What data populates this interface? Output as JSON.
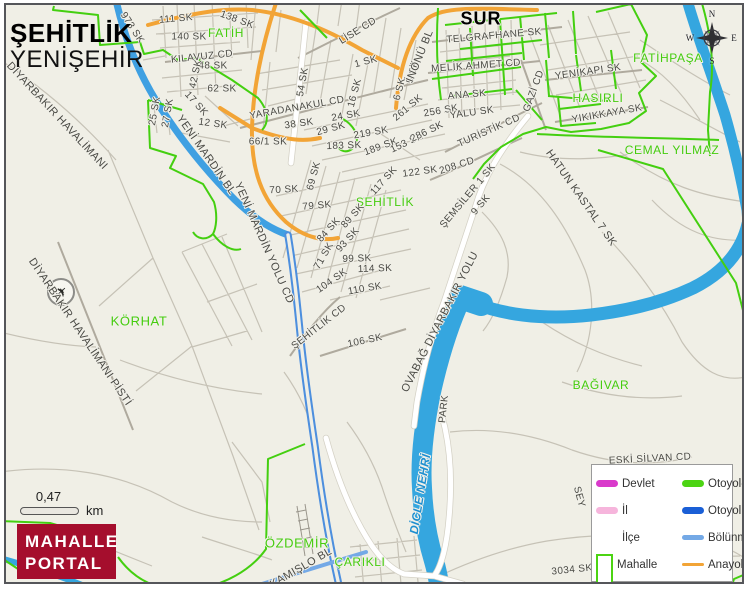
{
  "map_title": {
    "primary": "ŞEHİTLİK",
    "secondary": "YENİŞEHİR"
  },
  "scale_bar": {
    "distance": "0,47",
    "unit": "km"
  },
  "logo": {
    "line1": "MAHALLE",
    "line2": "PORTAL",
    "bg_color": "#A50E2D"
  },
  "compass": {
    "north": "N",
    "east": "E",
    "south": "S",
    "west": "W"
  },
  "legend": {
    "items": [
      {
        "label": "Devlet",
        "swatch": "line-thick",
        "color": "#D93ACB"
      },
      {
        "label": "İl",
        "swatch": "line-thick",
        "color": "#F6B5DC"
      },
      {
        "label": "İlçe",
        "swatch": "line-none",
        "color": "#FFFFFF"
      },
      {
        "label": "Mahalle",
        "swatch": "rect-outline",
        "color": "#4CD413"
      },
      {
        "label": "Otoyol-YİD",
        "swatch": "line-thick",
        "color": "#4CD413"
      },
      {
        "label": "Otoyol",
        "swatch": "line-thick",
        "color": "#1A5FD6"
      },
      {
        "label": "Bölünmüş Y",
        "swatch": "line-med",
        "color": "#74A9E6"
      },
      {
        "label": "Anayol",
        "swatch": "line-thin",
        "color": "#F2A436"
      }
    ]
  },
  "colors": {
    "background": "#F0EFE6",
    "river": "#35A6DF",
    "motorway_road": "#3FA0E2",
    "divided_road": "#4D8FDE",
    "main_road_orange": "#F2A436",
    "minor_road": "#C6C2B6",
    "major_road": "#AFAA9E",
    "boundary_green": "#44CF10",
    "white_road": "#FFFFFF",
    "label_green": "#45CC0E",
    "water_label": "#1E8FD0",
    "logo_red": "#A50E2D"
  },
  "labels": [
    {
      "t": "973 SK",
      "x": 132,
      "y": 28,
      "r": 57
    },
    {
      "t": "111 SK",
      "x": 176,
      "y": 19,
      "r": -5
    },
    {
      "t": "138 SK",
      "x": 237,
      "y": 20,
      "r": 20
    },
    {
      "t": "140 SK",
      "x": 189,
      "y": 37,
      "r": 0
    },
    {
      "t": "FATİH",
      "x": 226,
      "y": 33,
      "r": 0,
      "c": "mah"
    },
    {
      "t": "KILAVUZ CD",
      "x": 202,
      "y": 57,
      "r": -6
    },
    {
      "t": "48 SK",
      "x": 213,
      "y": 66,
      "r": 0
    },
    {
      "t": "42 SK",
      "x": 196,
      "y": 74,
      "r": -78
    },
    {
      "t": "62 SK",
      "x": 222,
      "y": 89,
      "r": 0
    },
    {
      "t": "17 SK",
      "x": 196,
      "y": 104,
      "r": 48
    },
    {
      "t": "12 SK",
      "x": 213,
      "y": 124,
      "r": 8
    },
    {
      "t": "25 SK",
      "x": 155,
      "y": 111,
      "r": -80
    },
    {
      "t": "27 SK",
      "x": 168,
      "y": 113,
      "r": -80
    },
    {
      "t": "DİYARBAKIR HAVALİMANI",
      "x": 57,
      "y": 116,
      "r": 47,
      "s": 11
    },
    {
      "t": "DİYARBAKIR HAVALİMANI PİSTİ",
      "x": 80,
      "y": 332,
      "r": 56,
      "s": 11
    },
    {
      "t": "KÖRHAT",
      "x": 139,
      "y": 321,
      "r": 0,
      "c": "mah",
      "s": 13
    },
    {
      "t": "YENİ MARDİN BL",
      "x": 206,
      "y": 155,
      "r": 55,
      "s": 11
    },
    {
      "t": "YENİ MARDİN YOLU CD",
      "x": 264,
      "y": 243,
      "r": 66,
      "s": 11
    },
    {
      "t": "66/1 SK",
      "x": 268,
      "y": 142,
      "r": 0
    },
    {
      "t": "YARADANAKUL CD",
      "x": 297,
      "y": 108,
      "r": -10
    },
    {
      "t": "38 SK",
      "x": 299,
      "y": 124,
      "r": -8
    },
    {
      "t": "29 SK",
      "x": 331,
      "y": 129,
      "r": -15
    },
    {
      "t": "219 SK",
      "x": 371,
      "y": 133,
      "r": -10
    },
    {
      "t": "183 SK",
      "x": 344,
      "y": 146,
      "r": -2
    },
    {
      "t": "189 SK",
      "x": 381,
      "y": 147,
      "r": -20
    },
    {
      "t": "153 SK",
      "x": 407,
      "y": 143,
      "r": -25
    },
    {
      "t": "24 SK",
      "x": 346,
      "y": 116,
      "r": -10
    },
    {
      "t": "16 SK",
      "x": 355,
      "y": 93,
      "r": -75
    },
    {
      "t": "54 SK",
      "x": 303,
      "y": 82,
      "r": -80
    },
    {
      "t": "1 SK",
      "x": 366,
      "y": 62,
      "r": -15
    },
    {
      "t": "LİSE CD",
      "x": 358,
      "y": 31,
      "r": -32
    },
    {
      "t": "5 SK",
      "x": 413,
      "y": 72,
      "r": -75
    },
    {
      "t": "6 SK",
      "x": 400,
      "y": 89,
      "r": -75
    },
    {
      "t": "261 SK",
      "x": 408,
      "y": 108,
      "r": -40
    },
    {
      "t": "256 SK",
      "x": 441,
      "y": 111,
      "r": -10
    },
    {
      "t": "286 SK",
      "x": 427,
      "y": 132,
      "r": -26
    },
    {
      "t": "122 SK",
      "x": 420,
      "y": 172,
      "r": -8
    },
    {
      "t": "208 CD",
      "x": 457,
      "y": 166,
      "r": -18
    },
    {
      "t": "TURİSTİK CD",
      "x": 489,
      "y": 131,
      "r": -24
    },
    {
      "t": "İNÖNÜ BL",
      "x": 420,
      "y": 56,
      "r": -68,
      "s": 11
    },
    {
      "t": "TELGRAFHANE SK",
      "x": 494,
      "y": 36,
      "r": -5
    },
    {
      "t": "MELİK AHMET CD",
      "x": 476,
      "y": 66,
      "r": -4
    },
    {
      "t": "ANA SK",
      "x": 467,
      "y": 95,
      "r": -5
    },
    {
      "t": "YALU SK",
      "x": 472,
      "y": 113,
      "r": -8
    },
    {
      "t": "GAZİ CD",
      "x": 534,
      "y": 91,
      "r": -70
    },
    {
      "t": "YENİKAPI SK",
      "x": 588,
      "y": 72,
      "r": -8
    },
    {
      "t": "HASIRLI",
      "x": 598,
      "y": 98,
      "r": 0,
      "c": "mah"
    },
    {
      "t": "YIKIKKAYA SK",
      "x": 607,
      "y": 114,
      "r": -10
    },
    {
      "t": "FATİHPAŞA",
      "x": 668,
      "y": 58,
      "r": 0,
      "c": "mah"
    },
    {
      "t": "CEMAL YILMAZ",
      "x": 672,
      "y": 150,
      "r": 0,
      "c": "mah"
    },
    {
      "t": "SUR",
      "x": 481,
      "y": 19,
      "r": 0,
      "c": "dist",
      "s": 18
    },
    {
      "t": "117 SK",
      "x": 384,
      "y": 181,
      "r": -48
    },
    {
      "t": "ŞEHİTLİK",
      "x": 385,
      "y": 202,
      "r": 0,
      "c": "mah"
    },
    {
      "t": "ŞEMSİLER 1 SK",
      "x": 468,
      "y": 196,
      "r": -50
    },
    {
      "t": "9 SK",
      "x": 481,
      "y": 205,
      "r": -50
    },
    {
      "t": "HATUN KASTAL 7 SK",
      "x": 581,
      "y": 198,
      "r": 55,
      "s": 11
    },
    {
      "t": "70 SK",
      "x": 284,
      "y": 190,
      "r": -3
    },
    {
      "t": "69 SK",
      "x": 314,
      "y": 176,
      "r": -75
    },
    {
      "t": "79 SK",
      "x": 317,
      "y": 206,
      "r": -5
    },
    {
      "t": "89 SK",
      "x": 353,
      "y": 216,
      "r": -48
    },
    {
      "t": "84 SK",
      "x": 329,
      "y": 230,
      "r": -48
    },
    {
      "t": "93 SK",
      "x": 348,
      "y": 240,
      "r": -48
    },
    {
      "t": "71 SK",
      "x": 324,
      "y": 256,
      "r": -60
    },
    {
      "t": "99 SK",
      "x": 357,
      "y": 259,
      "r": -2
    },
    {
      "t": "114 SK",
      "x": 375,
      "y": 269,
      "r": -2
    },
    {
      "t": "104 SK",
      "x": 332,
      "y": 281,
      "r": -35
    },
    {
      "t": "110 SK",
      "x": 365,
      "y": 289,
      "r": -10
    },
    {
      "t": "ŞEHİTLİK CD",
      "x": 319,
      "y": 327,
      "r": -38
    },
    {
      "t": "106 SK",
      "x": 365,
      "y": 341,
      "r": -12
    },
    {
      "t": "OVABAĞ DİYARBAKIR YOLU",
      "x": 440,
      "y": 322,
      "r": -63,
      "s": 11
    },
    {
      "t": "PARK",
      "x": 444,
      "y": 409,
      "r": -84
    },
    {
      "t": "DİCLE NEHRİ",
      "x": 420,
      "y": 494,
      "r": -81,
      "c": "water",
      "s": 12
    },
    {
      "t": "BAĞIVAR",
      "x": 601,
      "y": 385,
      "r": 0,
      "c": "mah"
    },
    {
      "t": "ÖZDEMİR",
      "x": 297,
      "y": 543,
      "r": 0,
      "c": "mah",
      "s": 13
    },
    {
      "t": "ÇARIKLI",
      "x": 360,
      "y": 562,
      "r": 0,
      "c": "mah"
    },
    {
      "t": "KAMIŞLO BL",
      "x": 301,
      "y": 568,
      "r": -30,
      "s": 11
    },
    {
      "t": "ESKİ SİLVAN CD",
      "x": 650,
      "y": 459,
      "r": -3
    },
    {
      "t": "SEY",
      "x": 579,
      "y": 497,
      "r": 75
    },
    {
      "t": "3034 SK",
      "x": 572,
      "y": 570,
      "r": -6
    }
  ]
}
